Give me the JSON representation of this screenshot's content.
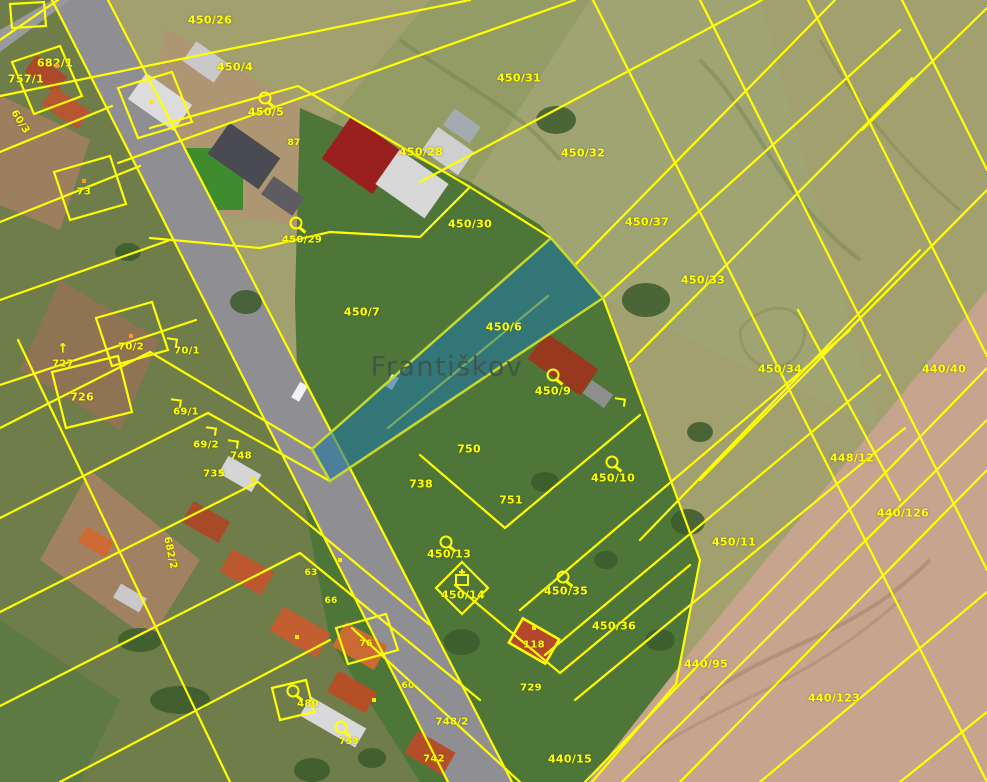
{
  "map": {
    "place_name": "Františkov",
    "colors": {
      "yellow": "#ffff00",
      "hl_fill": "rgba(36,118,158,0.62)",
      "hl_stroke": "#c6d92e",
      "road": "#8f8f93",
      "place": "#41524a",
      "dot_orange": "#ff9a2a",
      "dot_yellow": "#ffe800"
    },
    "labels": [
      {
        "text": "682/1",
        "x": 55,
        "y": 63
      },
      {
        "text": "450/26",
        "x": 210,
        "y": 20
      },
      {
        "text": "450/4",
        "x": 235,
        "y": 67
      },
      {
        "text": "450/31",
        "x": 519,
        "y": 78
      },
      {
        "text": "450/5",
        "x": 266,
        "y": 112
      },
      {
        "text": "450/28",
        "x": 421,
        "y": 152
      },
      {
        "text": "450/32",
        "x": 583,
        "y": 153
      },
      {
        "text": "450/30",
        "x": 470,
        "y": 224
      },
      {
        "text": "450/37",
        "x": 647,
        "y": 222
      },
      {
        "text": "450/33",
        "x": 703,
        "y": 280
      },
      {
        "text": "450/7",
        "x": 362,
        "y": 312
      },
      {
        "text": "450/6",
        "x": 504,
        "y": 327
      },
      {
        "text": "450/34",
        "x": 780,
        "y": 369
      },
      {
        "text": "440/40",
        "x": 944,
        "y": 369
      },
      {
        "text": "450/9",
        "x": 553,
        "y": 391
      },
      {
        "text": "757/1",
        "x": 26,
        "y": 79
      },
      {
        "text": "73",
        "x": 84,
        "y": 192,
        "size": 10
      },
      {
        "text": "60/3",
        "x": 20,
        "y": 122,
        "size": 10,
        "rot": 58
      },
      {
        "text": "70/2",
        "x": 131,
        "y": 347,
        "size": 10
      },
      {
        "text": "70/1",
        "x": 187,
        "y": 351,
        "size": 10
      },
      {
        "text": "727",
        "x": 63,
        "y": 364,
        "size": 10
      },
      {
        "text": "726",
        "x": 82,
        "y": 397
      },
      {
        "text": "69/1",
        "x": 186,
        "y": 412,
        "size": 10
      },
      {
        "text": "69/2",
        "x": 206,
        "y": 445,
        "size": 10
      },
      {
        "text": "748",
        "x": 241,
        "y": 456,
        "size": 10
      },
      {
        "text": "735",
        "x": 214,
        "y": 474,
        "size": 10
      },
      {
        "text": "682/2",
        "x": 170,
        "y": 553,
        "size": 10,
        "rot": 78
      },
      {
        "text": "750",
        "x": 469,
        "y": 449
      },
      {
        "text": "738",
        "x": 421,
        "y": 484
      },
      {
        "text": "751",
        "x": 511,
        "y": 500
      },
      {
        "text": "450/10",
        "x": 613,
        "y": 478
      },
      {
        "text": "448/12",
        "x": 852,
        "y": 458
      },
      {
        "text": "440/126",
        "x": 903,
        "y": 513
      },
      {
        "text": "450/11",
        "x": 734,
        "y": 542
      },
      {
        "text": "450/13",
        "x": 449,
        "y": 554
      },
      {
        "text": "450/14",
        "x": 463,
        "y": 595
      },
      {
        "text": "450/35",
        "x": 566,
        "y": 591
      },
      {
        "text": "450/36",
        "x": 614,
        "y": 626
      },
      {
        "text": "450/29",
        "x": 302,
        "y": 240,
        "size": 10
      },
      {
        "text": "87",
        "x": 294,
        "y": 143,
        "size": 9
      },
      {
        "text": "63",
        "x": 311,
        "y": 573,
        "size": 9
      },
      {
        "text": "66",
        "x": 331,
        "y": 601,
        "size": 9
      },
      {
        "text": "76",
        "x": 366,
        "y": 644,
        "size": 9
      },
      {
        "text": "60",
        "x": 408,
        "y": 686,
        "size": 9
      },
      {
        "text": "480",
        "x": 308,
        "y": 704,
        "size": 10
      },
      {
        "text": "753",
        "x": 349,
        "y": 742,
        "size": 9
      },
      {
        "text": "748/2",
        "x": 452,
        "y": 722,
        "size": 10
      },
      {
        "text": "742",
        "x": 434,
        "y": 759,
        "size": 10
      },
      {
        "text": "118",
        "x": 534,
        "y": 645,
        "size": 10
      },
      {
        "text": "729",
        "x": 531,
        "y": 688,
        "size": 10
      },
      {
        "text": "440/95",
        "x": 706,
        "y": 664
      },
      {
        "text": "440/123",
        "x": 834,
        "y": 698
      },
      {
        "text": "440/15",
        "x": 570,
        "y": 759
      }
    ],
    "icons": [
      {
        "type": "pin",
        "x": 265,
        "y": 98
      },
      {
        "type": "pin",
        "x": 553,
        "y": 375
      },
      {
        "type": "pin",
        "x": 612,
        "y": 462
      },
      {
        "type": "pin",
        "x": 446,
        "y": 542
      },
      {
        "type": "pin",
        "x": 563,
        "y": 577
      },
      {
        "type": "pin",
        "x": 341,
        "y": 727
      },
      {
        "type": "pin",
        "x": 296,
        "y": 223
      },
      {
        "type": "pin",
        "x": 293,
        "y": 691
      },
      {
        "type": "chapel",
        "x": 462,
        "y": 580
      },
      {
        "type": "arrow-up",
        "x": 63,
        "y": 349
      },
      {
        "type": "hook",
        "x": 172,
        "y": 342
      },
      {
        "type": "hook",
        "x": 176,
        "y": 403
      },
      {
        "type": "hook",
        "x": 211,
        "y": 431
      },
      {
        "type": "hook",
        "x": 233,
        "y": 444
      },
      {
        "type": "hook",
        "x": 620,
        "y": 402
      },
      {
        "type": "dot-orange",
        "x": 57,
        "y": 66
      },
      {
        "type": "dot-orange",
        "x": 84,
        "y": 181
      },
      {
        "type": "dot-orange",
        "x": 131,
        "y": 336
      },
      {
        "type": "dot-yellow",
        "x": 152,
        "y": 102
      },
      {
        "type": "dot-yellow",
        "x": 253,
        "y": 480
      },
      {
        "type": "dot-yellow",
        "x": 340,
        "y": 560
      },
      {
        "type": "dot-yellow",
        "x": 297,
        "y": 637
      },
      {
        "type": "dot-yellow",
        "x": 374,
        "y": 700
      },
      {
        "type": "dot-yellow",
        "x": 534,
        "y": 628
      }
    ]
  }
}
